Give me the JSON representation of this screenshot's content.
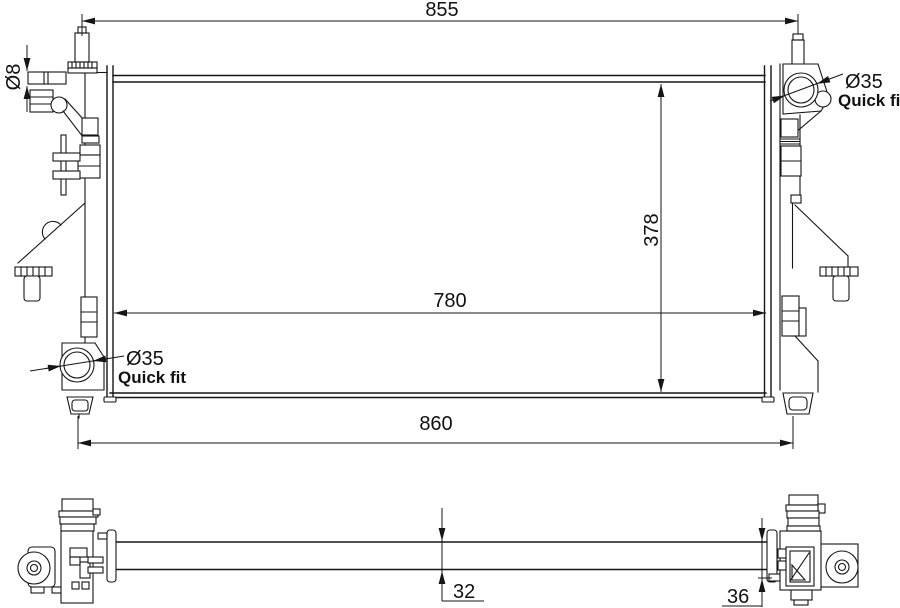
{
  "dimensions": {
    "top_width": "855",
    "core_width": "780",
    "bottom_width": "860",
    "core_height": "378",
    "overflow_pipe_diameter": "Ø8",
    "core_thickness": "32",
    "end_tank_thickness": "36"
  },
  "connectors": {
    "top_right": {
      "diameter": "Ø35",
      "type": "Quick fit"
    },
    "bottom_left": {
      "diameter": "Ø35",
      "type": "Quick fit"
    }
  },
  "colors": {
    "line": "#151515",
    "background": "#ffffff"
  }
}
